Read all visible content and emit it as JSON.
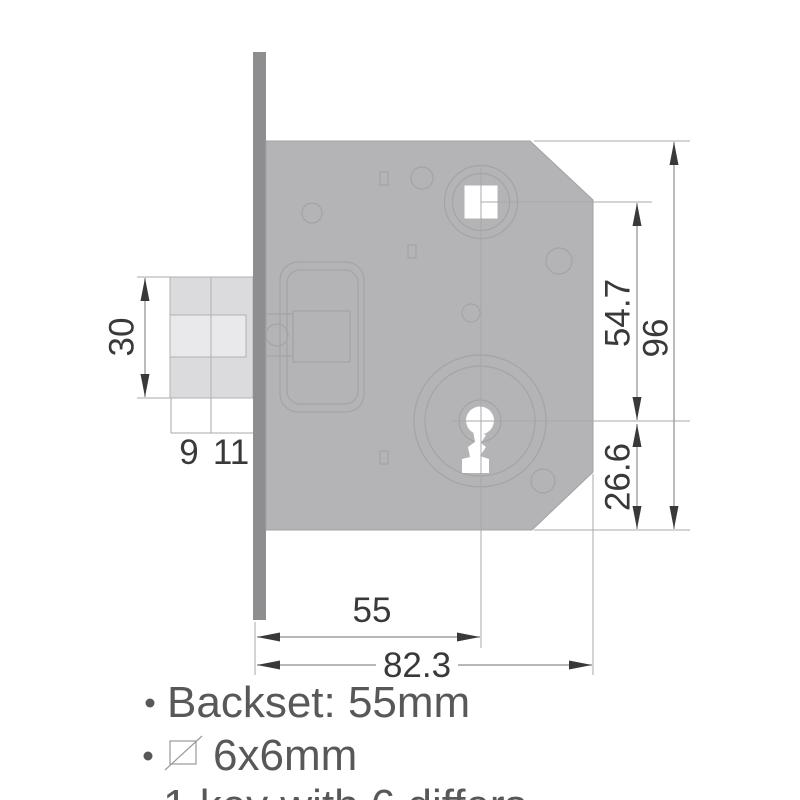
{
  "drawing_title": "mortise-lock-dimension-drawing",
  "dims": {
    "latch_height": "30",
    "latch_front": "9",
    "latch_back": "11",
    "backset": "55",
    "body_depth": "82.3",
    "spindle_to_keyhole": "54.7",
    "keyhole_to_bottom": "26.6",
    "body_height": "96"
  },
  "notes": {
    "backset": "Backset: 55mm",
    "spindle": "6x6mm",
    "keys": "1 key with 6 differs",
    "bullet": "•"
  },
  "colors": {
    "body-fill": "#b4b4b6",
    "body-stroke": "#a2a2a4",
    "faceplate-fill": "#8e8e90",
    "latch-fill": "#dbdbdd",
    "latch-band-fill": "#e9e9eb",
    "latch-stroke": "#b2b2b4",
    "outline": "#a4a4a6",
    "thin-line": "#a8a8aa",
    "dim-line": "#8e8e90",
    "dim-ink": "#39393b",
    "note-ink": "#58585a"
  }
}
